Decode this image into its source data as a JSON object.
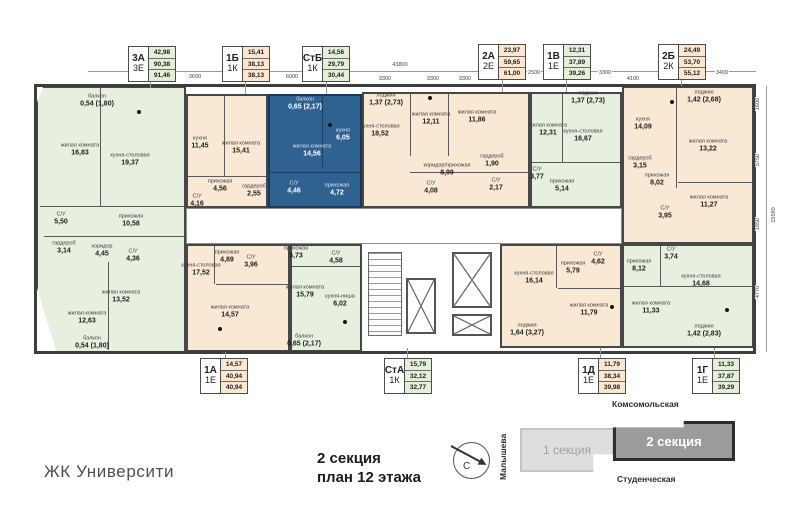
{
  "footer": {
    "logo": "ЖК Университи",
    "caption_line1": "2 секция",
    "caption_line2": "план 12 этажа"
  },
  "minimap": {
    "street_top": "Комсомольская",
    "street_bottom": "Студенческая",
    "street_left": "Малышева",
    "section1_label": "1 секция",
    "section2_label": "2 секция",
    "compass_label": "С"
  },
  "dimensions": {
    "top_total": "43800",
    "top_segments": [
      "3600",
      "6000",
      "3300",
      "3300",
      "3300",
      "2500",
      "3300",
      "4100",
      "3400"
    ],
    "right_total": "15590",
    "right_segments": [
      "1600",
      "5750",
      "1850",
      "4770"
    ]
  },
  "colors": {
    "green_apartment": "#e7efdf",
    "beige_apartment": "#f9e8d3",
    "selected_apartment_blue": "#2f6191",
    "wall": "#474747"
  },
  "legend_top": [
    {
      "code": "3А",
      "type": "3Е",
      "v1": "42,98",
      "v2": "90,38",
      "v3": "91,46",
      "variant": "green"
    },
    {
      "code": "1Б",
      "type": "1К",
      "v1": "15,41",
      "v2": "38,13",
      "v3": "38,13",
      "variant": "beige"
    },
    {
      "code": "СтБ",
      "type": "1К",
      "v1": "14,56",
      "v2": "29,79",
      "v3": "30,44",
      "variant": "green"
    },
    {
      "code": "2А",
      "type": "2Е",
      "v1": "23,97",
      "v2": "59,65",
      "v3": "61,00",
      "variant": "beige"
    },
    {
      "code": "1В",
      "type": "1Е",
      "v1": "12,31",
      "v2": "37,89",
      "v3": "39,26",
      "variant": "green"
    },
    {
      "code": "2Б",
      "type": "2К",
      "v1": "24,49",
      "v2": "53,70",
      "v3": "55,12",
      "variant": "beige"
    }
  ],
  "legend_bottom": [
    {
      "code": "1А",
      "type": "1Е",
      "v1": "14,57",
      "v2": "40,94",
      "v3": "40,94",
      "variant": "beige"
    },
    {
      "code": "СтА",
      "type": "1К",
      "v1": "15,79",
      "v2": "32,12",
      "v3": "32,77",
      "variant": "green"
    },
    {
      "code": "1Д",
      "type": "1Е",
      "v1": "11,79",
      "v2": "38,34",
      "v3": "39,98",
      "variant": "beige"
    },
    {
      "code": "1Г",
      "type": "1Е",
      "v1": "11,33",
      "v2": "37,87",
      "v3": "39,29",
      "variant": "green"
    }
  ],
  "apartments": {
    "a3a": {
      "code": "3А",
      "rooms": [
        {
          "name": "балкон",
          "area": "0,54 (1,80)"
        },
        {
          "name": "жилая комната",
          "area": "16,83"
        },
        {
          "name": "кухня-столовая",
          "area": "19,37"
        },
        {
          "name": "прихожая",
          "area": "10,58"
        },
        {
          "name": "С/У",
          "area": "5,50"
        },
        {
          "name": "гардероб",
          "area": "3,14"
        },
        {
          "name": "коридор",
          "area": "4,45"
        },
        {
          "name": "С/У",
          "area": "4,36"
        },
        {
          "name": "жилая комната",
          "area": "13,52"
        },
        {
          "name": "жилая комната",
          "area": "12,63"
        },
        {
          "name": "балкон",
          "area": "0,54 (1,80)"
        }
      ]
    },
    "a1b": {
      "code": "1Б",
      "rooms": [
        {
          "name": "кухня",
          "area": "11,45"
        },
        {
          "name": "жилая комната",
          "area": "15,41"
        },
        {
          "name": "прихожая",
          "area": "4,56"
        },
        {
          "name": "гардероб",
          "area": "2,55"
        },
        {
          "name": "С/У",
          "area": "4,16"
        }
      ]
    },
    "astb": {
      "code": "СтБ",
      "rooms": [
        {
          "name": "балкон",
          "area": "0,65 (2,17)"
        },
        {
          "name": "жилая комната",
          "area": "14,56"
        },
        {
          "name": "кухня",
          "area": "6,05"
        },
        {
          "name": "С/У",
          "area": "4,46"
        },
        {
          "name": "прихожая",
          "area": "4,72"
        }
      ]
    },
    "a2a": {
      "code": "2А",
      "rooms": [
        {
          "name": "лоджия",
          "area": "1,37 (2,73)"
        },
        {
          "name": "кухня-столовая",
          "area": "18,52"
        },
        {
          "name": "жилая комната",
          "area": "12,11"
        },
        {
          "name": "жилая комната",
          "area": "11,86"
        },
        {
          "name": "коридор/прихожая",
          "area": "8,99"
        },
        {
          "name": "С/У",
          "area": "4,08"
        },
        {
          "name": "гардероб",
          "area": "1,90"
        },
        {
          "name": "С/У",
          "area": "2,17"
        }
      ]
    },
    "a1v": {
      "code": "1В",
      "rooms": [
        {
          "name": "лоджия",
          "area": "1,37 (2,73)"
        },
        {
          "name": "жилая комната",
          "area": "12,31"
        },
        {
          "name": "кухня-столовая",
          "area": "16,67"
        },
        {
          "name": "С/У",
          "area": "3,77"
        },
        {
          "name": "прихожая",
          "area": "5,14"
        }
      ]
    },
    "a2b": {
      "code": "2Б",
      "rooms": [
        {
          "name": "лоджия",
          "area": "1,42 (2,68)"
        },
        {
          "name": "кухня",
          "area": "14,09"
        },
        {
          "name": "жилая комната",
          "area": "13,22"
        },
        {
          "name": "гардероб",
          "area": "3,15"
        },
        {
          "name": "прихожая",
          "area": "8,02"
        },
        {
          "name": "жилая комната",
          "area": "11,27"
        },
        {
          "name": "С/У",
          "area": "3,95"
        }
      ]
    },
    "a1a": {
      "code": "1А",
      "rooms": [
        {
          "name": "прихожая",
          "area": "4,89"
        },
        {
          "name": "С/У",
          "area": "3,96"
        },
        {
          "name": "кухня-столовая",
          "area": "17,52"
        },
        {
          "name": "жилая комната",
          "area": "14,57"
        }
      ]
    },
    "asta": {
      "code": "СтА",
      "rooms": [
        {
          "name": "прихожая",
          "area": "5,73"
        },
        {
          "name": "С/У",
          "area": "4,58"
        },
        {
          "name": "жилая комната",
          "area": "15,79"
        },
        {
          "name": "кухня-ниша",
          "area": "6,02"
        },
        {
          "name": "балкон",
          "area": "0,65 (2,17)"
        }
      ]
    },
    "a1d": {
      "code": "1Д",
      "rooms": [
        {
          "name": "кухня-столовая",
          "area": "16,14"
        },
        {
          "name": "прихожая",
          "area": "5,79"
        },
        {
          "name": "С/У",
          "area": "4,62"
        },
        {
          "name": "жилая комната",
          "area": "11,79"
        },
        {
          "name": "лоджия",
          "area": "1,64 (3,27)"
        }
      ]
    },
    "a1g": {
      "code": "1Г",
      "rooms": [
        {
          "name": "прихожая",
          "area": "8,12"
        },
        {
          "name": "С/У",
          "area": "3,74"
        },
        {
          "name": "кухня-столовая",
          "area": "14,68"
        },
        {
          "name": "жилая комната",
          "area": "11,33"
        },
        {
          "name": "лоджия",
          "area": "1,42 (2,83)"
        }
      ]
    }
  }
}
